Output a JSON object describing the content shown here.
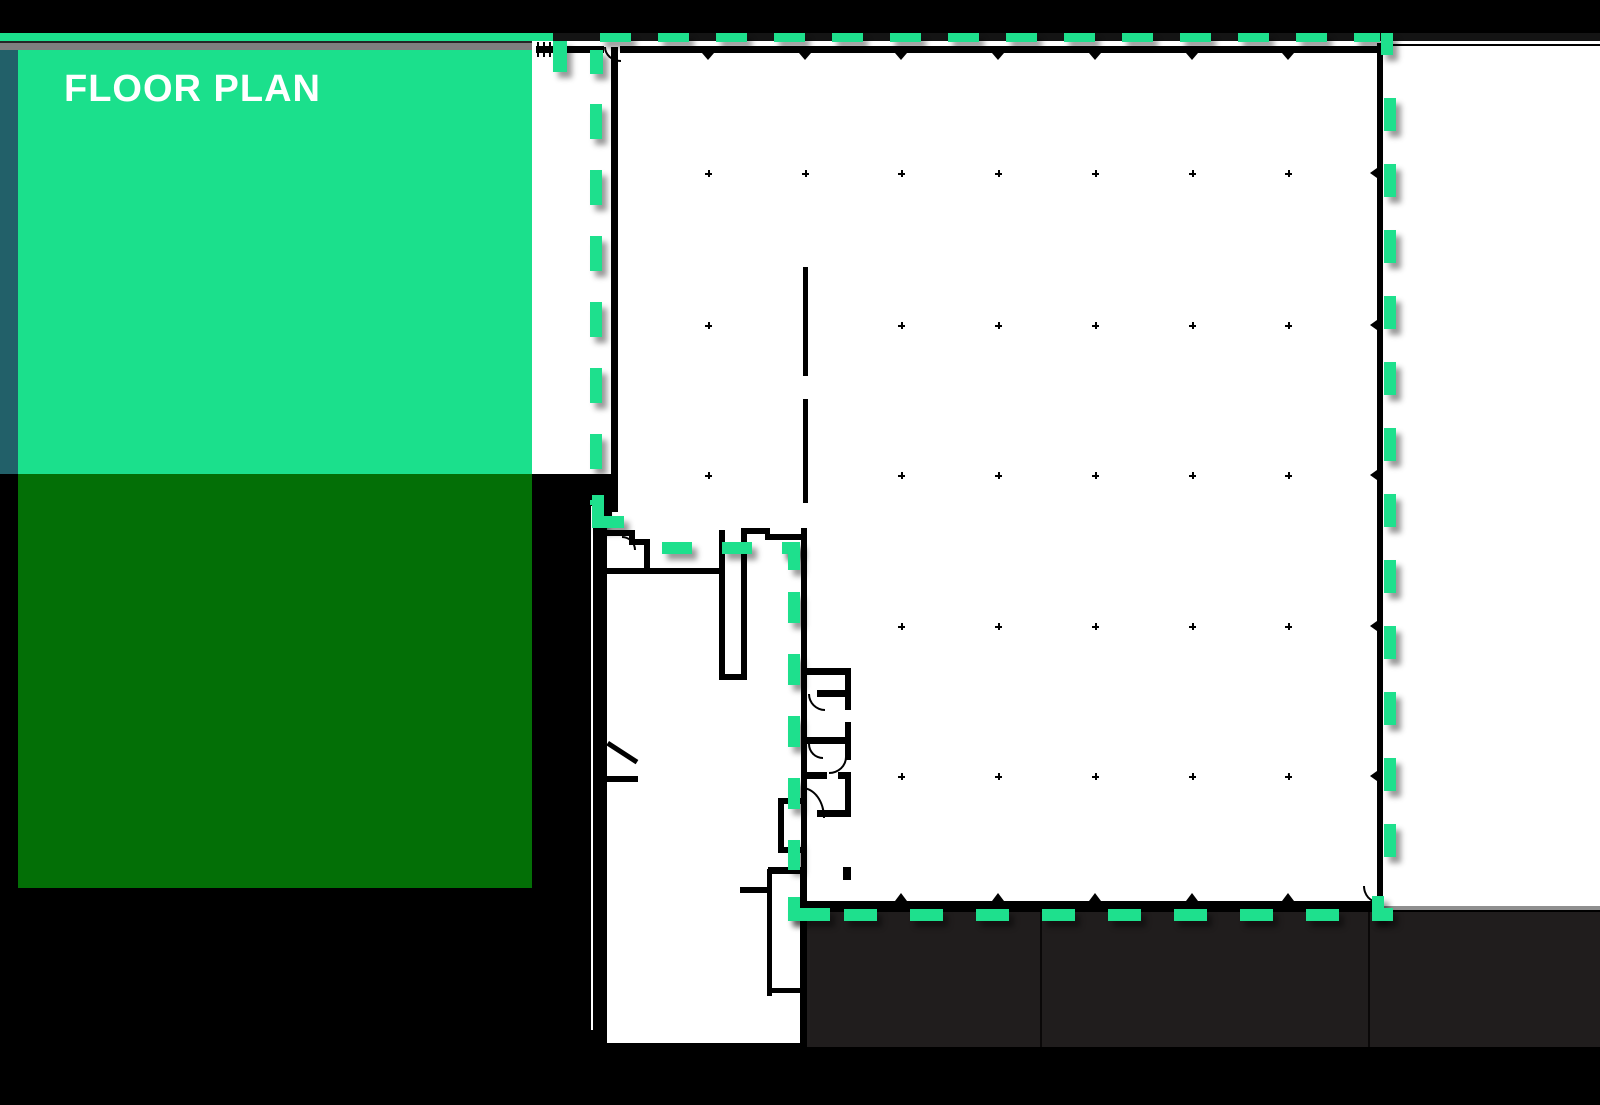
{
  "title": {
    "label": "FLOOR PLAN"
  },
  "colors": {
    "background": "#000000",
    "accent_green": "#1EE08D",
    "box_green": "#1BE08C",
    "box_dark_green": "#036F06",
    "teal_edge": "#226069",
    "gray_strip": "#7F7F7F",
    "plan_white": "#FFFFFF",
    "wall_black": "#000000",
    "dock_charcoal": "#201D1D",
    "top_bar_black": "#141414"
  },
  "plan": {
    "highlight_border": {
      "style": "dashed",
      "color": "#1EE08D"
    },
    "grid": {
      "cols": [
        708,
        805,
        901,
        998,
        1095,
        1192,
        1288
      ],
      "rows": [
        173,
        325,
        475,
        626,
        776
      ],
      "dots": [
        [
          708,
          173
        ],
        [
          805,
          173
        ],
        [
          901,
          173
        ],
        [
          998,
          173
        ],
        [
          1095,
          173
        ],
        [
          1192,
          173
        ],
        [
          1288,
          173
        ],
        [
          708,
          325
        ],
        [
          901,
          325
        ],
        [
          998,
          325
        ],
        [
          1095,
          325
        ],
        [
          1192,
          325
        ],
        [
          1288,
          325
        ],
        [
          708,
          475
        ],
        [
          901,
          475
        ],
        [
          998,
          475
        ],
        [
          1095,
          475
        ],
        [
          1192,
          475
        ],
        [
          1288,
          475
        ],
        [
          901,
          626
        ],
        [
          998,
          626
        ],
        [
          1095,
          626
        ],
        [
          1192,
          626
        ],
        [
          1288,
          626
        ],
        [
          901,
          776
        ],
        [
          998,
          776
        ],
        [
          1095,
          776
        ],
        [
          1192,
          776
        ],
        [
          1288,
          776
        ]
      ]
    }
  }
}
